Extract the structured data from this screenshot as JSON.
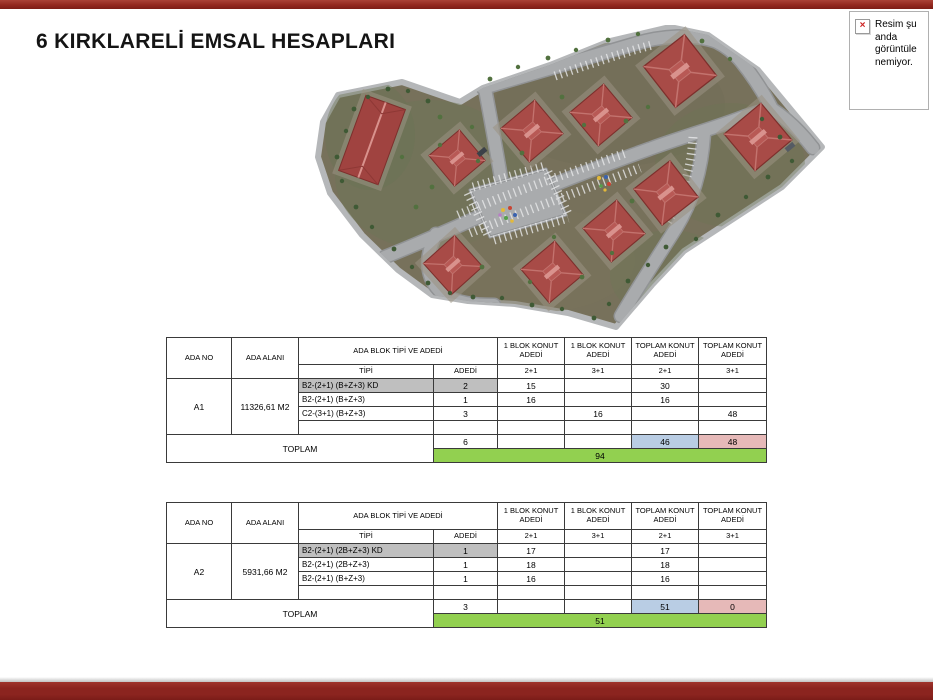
{
  "page": {
    "title": "6 KIRKLARELİ EMSAL HESAPLARI"
  },
  "broken_image": {
    "lines": [
      "Resim şu",
      "anda",
      "görüntüle",
      "nemiyor."
    ],
    "icon_glyph": "×"
  },
  "colors": {
    "accent_red": "#93281f",
    "highlight_gray": "#bfbfbf",
    "total_blue": "#b9cde4",
    "total_pink": "#e6b9b8",
    "total_green": "#92d050"
  },
  "table_headers": {
    "ada_no": "ADA NO",
    "ada_alani": "ADA ALANI",
    "ada_blok": "ADA BLOK TİPİ VE ADEDİ",
    "blok_konut": "1 BLOK KONUT ADEDİ",
    "toplam_konut": "TOPLAM KONUT ADEDİ",
    "tipi": "TİPİ",
    "adedi": "ADEDİ",
    "t21": "2+1",
    "t31": "3+1",
    "toplam": "TOPLAM"
  },
  "tables": [
    {
      "ada_no": "A1",
      "ada_alani": "11326,61 M2",
      "rows": [
        {
          "tipi": "B2-(2+1) (B+Z+3) KD",
          "adedi": "2",
          "b21": "15",
          "b31": "",
          "t21": "30",
          "t31": ""
        },
        {
          "tipi": "B2-(2+1) (B+Z+3)",
          "adedi": "1",
          "b21": "16",
          "b31": "",
          "t21": "16",
          "t31": ""
        },
        {
          "tipi": "C2-(3+1) (B+Z+3)",
          "adedi": "3",
          "b21": "",
          "b31": "16",
          "t21": "",
          "t31": "48"
        }
      ],
      "toplam": {
        "adedi": "6",
        "b21": "",
        "b31": "",
        "t21": "46",
        "t31": "48",
        "genel": "94"
      }
    },
    {
      "ada_no": "A2",
      "ada_alani": "5931,66 M2",
      "rows": [
        {
          "tipi": "B2-(2+1) (2B+Z+3) KD",
          "adedi": "1",
          "b21": "17",
          "b31": "",
          "t21": "17",
          "t31": ""
        },
        {
          "tipi": "B2-(2+1) (2B+Z+3)",
          "adedi": "1",
          "b21": "18",
          "b31": "",
          "t21": "18",
          "t31": ""
        },
        {
          "tipi": "B2-(2+1) (B+Z+3)",
          "adedi": "1",
          "b21": "16",
          "b31": "",
          "t21": "16",
          "t31": ""
        }
      ],
      "toplam": {
        "adedi": "3",
        "b21": "",
        "b31": "",
        "t21": "51",
        "t31": "0",
        "genel": "51"
      }
    }
  ]
}
